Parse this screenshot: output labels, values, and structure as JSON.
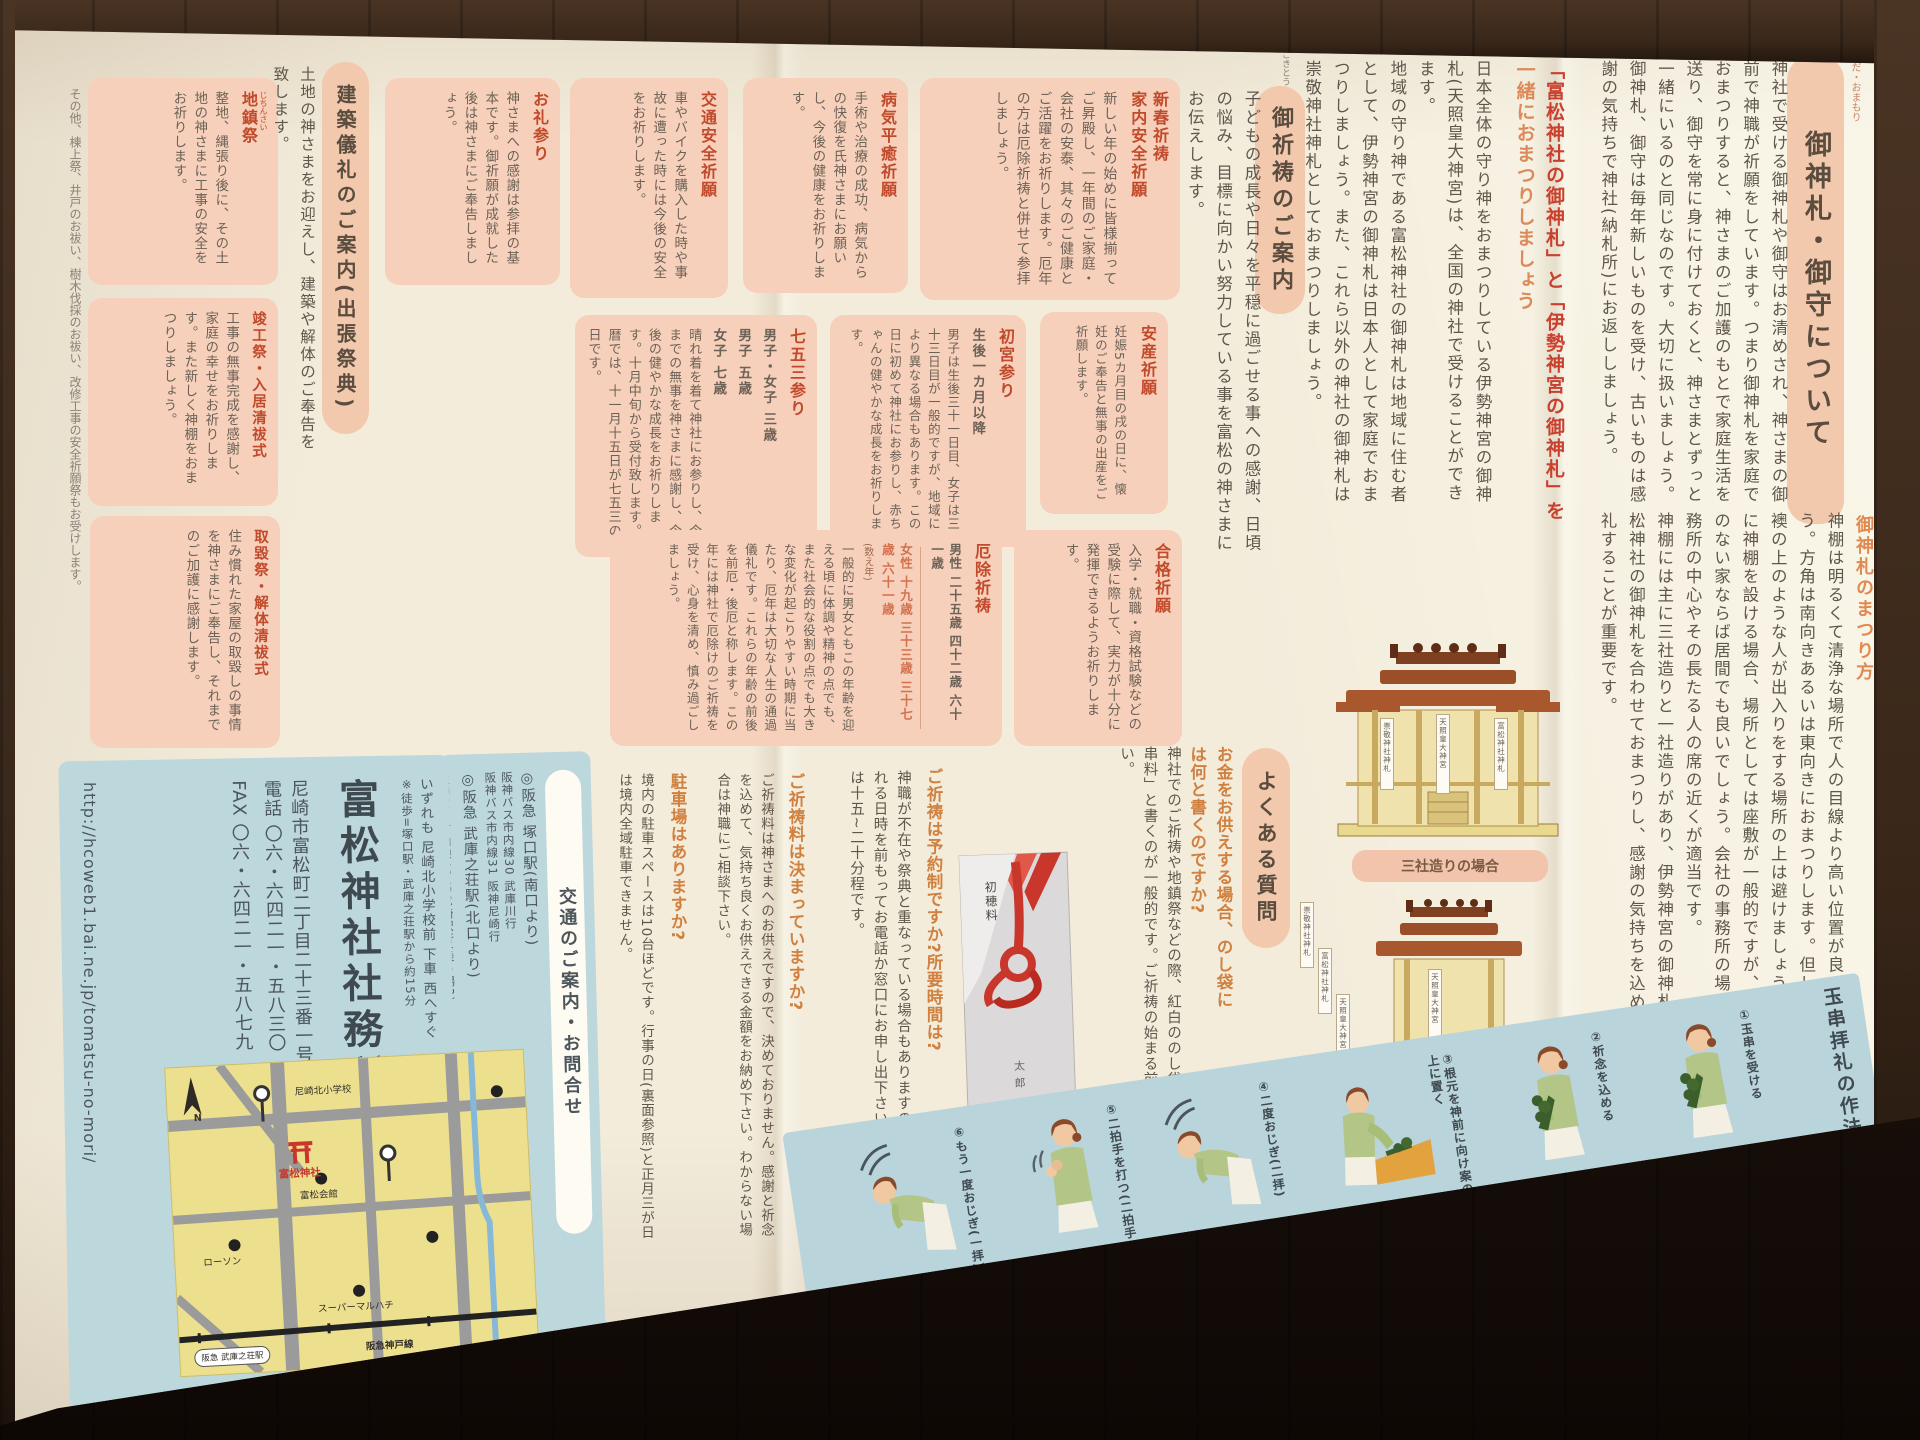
{
  "colors": {
    "accent_red": "#c24a2c",
    "box_pink": "#f6d0ba",
    "panel_blue": "#bcd8dc",
    "strip_blue": "#b9d4da",
    "heading_pill": "#f2c9ad",
    "faq_orange": "#d0803f",
    "map_yellow": "#ece08f",
    "wood_brown": "#3a281a"
  },
  "ofuda": {
    "furigana": "おふだ・おまもり",
    "title": "御神札・御守について",
    "p1": "神社で受ける御神札や御守はお清めされ、神さまの御前で神職が祈願をしています。つまり御神札を家庭でおまつりすると、神さまのご加護のもとで家庭生活を送り、御守を常に身に付けておくと、神さまとずっと一緒にいるのと同じなのです。大切に扱いましょう。",
    "p2": "御神札、御守は毎年新しいものを受け、古いものは感謝の気持ちで神社(納札所)にお返ししましょう。",
    "sub1a": "「富松神社の御神札」と「伊勢神宮の御神札」を",
    "sub1b": "一緒におまつりしましょう",
    "p3": "日本全体の守り神をおまつりしている伊勢神宮の御神札(天照皇大神宮)は、全国の神社で受けることができます。",
    "p4": "地域の守り神である富松神社の御神札は地域に住む者として、伊勢神宮の御神札は日本人として家庭でおまつりしましょう。また、これら以外の神社の御神札は崇敬神社神札としておまつりしましょう。",
    "matsuri_title": "御神札のまつり方",
    "p5": "神棚は明るくて清浄な場所で人の目線より高い位置が良いでしょう。方角は南向きあるいは東向きにおまつりします。但し、扉や襖の上のような人が出入りをする場所の上は避けましょう。家具に神棚を設ける場合、場所としては座敷が一般的ですが、床の間のない家ならば居間でも良いでしょう。会社の事務所の場合、事務所の中心やその長たる人の席の近くが適当です。",
    "p6": "神棚には主に三社造りと一社造りがあり、伊勢神宮の御神札と富松神社の御神札を合わせておまつりし、感謝の気持ちを込めて拝礼することが重要です。"
  },
  "altars": {
    "sanja_label": "三社造りの場合",
    "issha_label": "一社造りの場合",
    "tag1": "崇敬神社神札",
    "tag2": "天照皇大神宮",
    "tag3": "富松神社神札"
  },
  "gokito": {
    "furigana": "ごきとう",
    "title": "御祈祷のご案内",
    "intro": "子どもの成長や日々を平穏に過ごせる事への感謝、日頃の悩み、目標に向かい努力している事を富松の神さまにお伝えします。"
  },
  "boxes": {
    "shinshun": {
      "t1": "新春祈祷",
      "t2": "家内安全祈願",
      "body": "新しい年の始めに皆様揃ってご昇殿し、一年間のご家庭・会社の安泰、其々のご健康とご活躍をお祈りします。厄年の方は厄除祈祷と併せて参拝しましょう。"
    },
    "byoki": {
      "t": "病気平癒祈願",
      "body": "手術や治療の成功、病気からの快復を氏神さまにお願いし、今後の健康をお祈りします。"
    },
    "kotsu": {
      "t": "交通安全祈願",
      "body": "車やバイクを購入した時や事故に遭った時には今後の安全をお祈りします。"
    },
    "orei": {
      "t": "お礼参り",
      "body": "神さまへの感謝は参拝の基本です。御祈願が成就した後は神さまにご奉告しましょう。"
    },
    "anzan": {
      "t": "安産祈願",
      "body": "妊娠5カ月目の戌の日に、懐妊のご奉告と無事の出産をご祈願します。"
    },
    "hatsumiya": {
      "t": "初宮参り",
      "lead": "生後一カ月以降",
      "body": "男子は生後三十一日目、女子は三十三日目が一般的ですが、地域により異なる場合もあります。この日に初めて神社にお参りし、赤ちゃんの健やかな成長をお祈りします。"
    },
    "shichigosan": {
      "t": "七五三参り",
      "a1": "男子・女子 三歳",
      "a2": "男子 五歳",
      "a3": "女子 七歳",
      "body": "晴れ着を着て神社にお参りし、今までの無事を神さまに感謝し、今後の健やかな成長をお祈りします。十月中旬から受付致します。暦では、十一月十五日が七五三の日です。"
    },
    "gokaku": {
      "t": "合格祈願",
      "body": "入学・就職・資格試験などの受験に際して、実力が十分に発揮できるようお祈りします。"
    },
    "yakuyoke": {
      "t": "厄除祈祷",
      "male": "男性 二十五歳 四十二歳 六十一歳",
      "female": "女性 十九歳 三十三歳 三十七歳 六十一歳",
      "note": "(数え年)",
      "body": "一般的に男女ともこの年齢を迎える頃に体調や精神の点でも、また社会的な役割の点でも大きな変化が起こりやすい時期に当たり、厄年は大切な人生の通過儀礼です。これらの年齢の前後を前厄・後厄と称します。この年には神社で厄除けのご祈祷を受け、心身を清め、慎み過ごしましょう。"
    }
  },
  "kenchiku": {
    "title": "建築儀礼のご案内(出張祭典)",
    "intro": "土地の神さまをお迎えし、建築や解体のご奉告を致します。",
    "jichin_furi": "じちんさい",
    "jichin_t": "地鎮祭",
    "jichin_body": "整地、縄張り後に、その土地の神さまに工事の安全をお祈りします。",
    "shunko_t": "竣工祭・入居清祓式",
    "shunko_body": "工事の無事完成を感謝し、家庭の幸せをお祈りします。また新しく神棚をおまつりしましょう。",
    "tori_t": "取毀祭・解体清祓式",
    "tori_body": "住み慣れた家屋の取毀しの事情を神さまにご奉告し、それまでのご加護に感謝します。",
    "note": "その他、棟上祭、井戸のお祓い、樹木伐採のお祓い、改修工事の安全祈願祭もお受けします。"
  },
  "faq": {
    "title": "よくある質問",
    "q1": "お金をお供えする場合、のし袋には何と書くのですか?",
    "a1": "神社でのご祈祷や地鎮祭などの際、紅白ののし袋に「初穂料」か「玉串料」と書くのが一般的です。ご祈祷の始まる前に神職にお渡し下さい。",
    "q2": "ご祈祷は予約制ですか?所要時間は?",
    "a2": "神職が不在や祭典と重なっている場合もありますので、必ず来社される日時を前もってお電話か窓口にお申し出下さい。ご祈祷の時間は十五~二十分程です。",
    "q3": "ご祈祷料は決まっていますか?",
    "a3": "ご祈祷料は神さまへのお供えですので、決めておりません。感謝と祈念を込めて、気持ち良くお供えできる金額をお納め下さい。わからない場合は神職にご相談下さい。",
    "q4": "駐車場はありますか?",
    "a4": "境内の駐車スペースは10台ほどです。行事の日(裏面参照)と正月三が日は境内全域駐車できません。"
  },
  "envelope": {
    "label": "初穂料",
    "name": "太郎"
  },
  "office": {
    "name": "富松神社社務所",
    "address": "尼崎市富松町二丁目二十三番一号",
    "tel": "電話 〇六・六四二一・五八三〇",
    "fax": "FAX 〇六・六四二一・五八七九",
    "url": "http://hcoweb1.bai.ne.jp/tomatsu-no-mori/"
  },
  "access": {
    "title": "交通のご案内・お問合せ",
    "st1": "◎阪急 塚口駅(南口より)",
    "bus1": "阪神バス市内線30 武庫川行",
    "bus2": "阪神バス市内線31 阪神尼崎行",
    "st2": "◎阪急 武庫之荘駅(北口より)",
    "bus3": "阪神バス市内線48 JR尼崎駅行(乗り場3)",
    "both": "いずれも 尼崎北小学校前 下車 西へすぐ",
    "walk": "※徒歩=塚口駅・武庫之荘駅から約15分"
  },
  "map": {
    "n": "N",
    "shrine": "富松神社",
    "e1": "ローソン",
    "e2": "富松会館",
    "e3": "尼崎北小学校",
    "e4": "スーパーマルハチ",
    "rail": "阪急神戸線",
    "station": "阪急 武庫之荘駅"
  },
  "tamagushi": {
    "title": "玉串拝礼の作法",
    "steps": [
      {
        "label": "①玉串を受ける"
      },
      {
        "label": "②祈念を込める"
      },
      {
        "label": "③根元を神前に向け案の上に置く"
      },
      {
        "label": "④二度おじぎ(二拝)"
      },
      {
        "label": "⑤二拍手を打つ(二拍手)"
      },
      {
        "label": "⑥もう一度おじぎ(一拝)"
      }
    ]
  }
}
